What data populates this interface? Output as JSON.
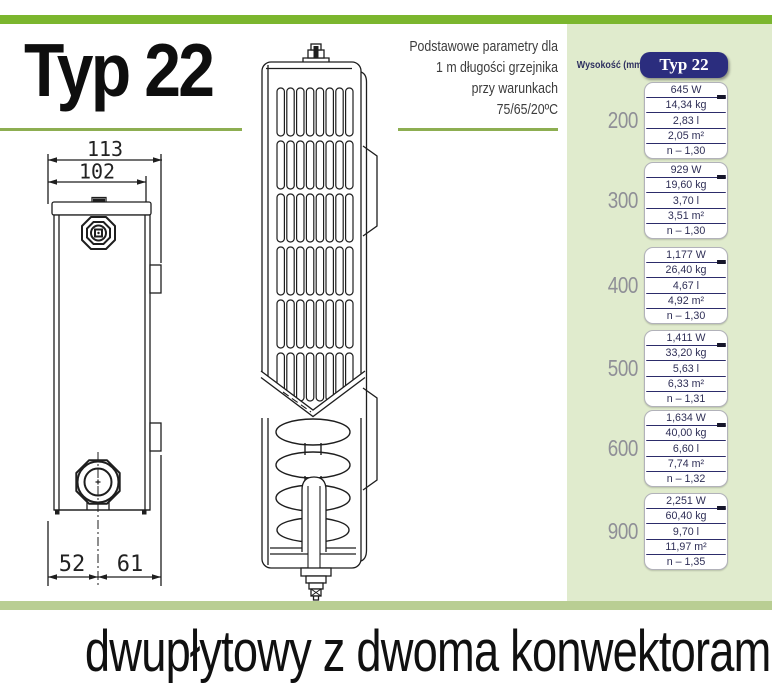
{
  "header": {
    "title": "Typ 22",
    "note_lines": [
      "Podstawowe parametry dla",
      "1 m długości grzejnika",
      "przy warunkach",
      "75/65/20ºC"
    ]
  },
  "drawings": {
    "front": {
      "dims": {
        "total_depth": "113",
        "panel_depth": "102",
        "bottom_left": "52",
        "bottom_right": "61"
      }
    }
  },
  "table": {
    "col_header": "Wysokość (mm)",
    "type_header": "Typ 22",
    "groups": [
      {
        "height": "200",
        "values": [
          "645 W",
          "14,34 kg",
          "2,83 l",
          "2,05 m²",
          "n – 1,30"
        ]
      },
      {
        "height": "300",
        "values": [
          "929 W",
          "19,60 kg",
          "3,70 l",
          "3,51 m²",
          "n – 1,30"
        ]
      },
      {
        "height": "400",
        "values": [
          "1,177 W",
          "26,40 kg",
          "4,67 l",
          "4,92 m²",
          "n – 1,30"
        ]
      },
      {
        "height": "500",
        "values": [
          "1,411 W",
          "33,20 kg",
          "5,63 l",
          "6,33 m²",
          "n – 1,31"
        ]
      },
      {
        "height": "600",
        "values": [
          "1,634 W",
          "40,00 kg",
          "6,60 l",
          "7,74 m²",
          "n – 1,32"
        ]
      },
      {
        "height": "900",
        "values": [
          "2,251 W",
          "60,40 kg",
          "9,70 l",
          "11,97 m²",
          "n – 1,35"
        ]
      }
    ]
  },
  "footer": {
    "caption": "dwupłytowy z dwoma konwektorami"
  },
  "colors": {
    "top_bar": "#7bb62e",
    "underline": "#8dae51",
    "side_panel": "#e0ebcd",
    "bottom_bar": "#b9ce93",
    "table_navy": "#2b2d7e"
  }
}
